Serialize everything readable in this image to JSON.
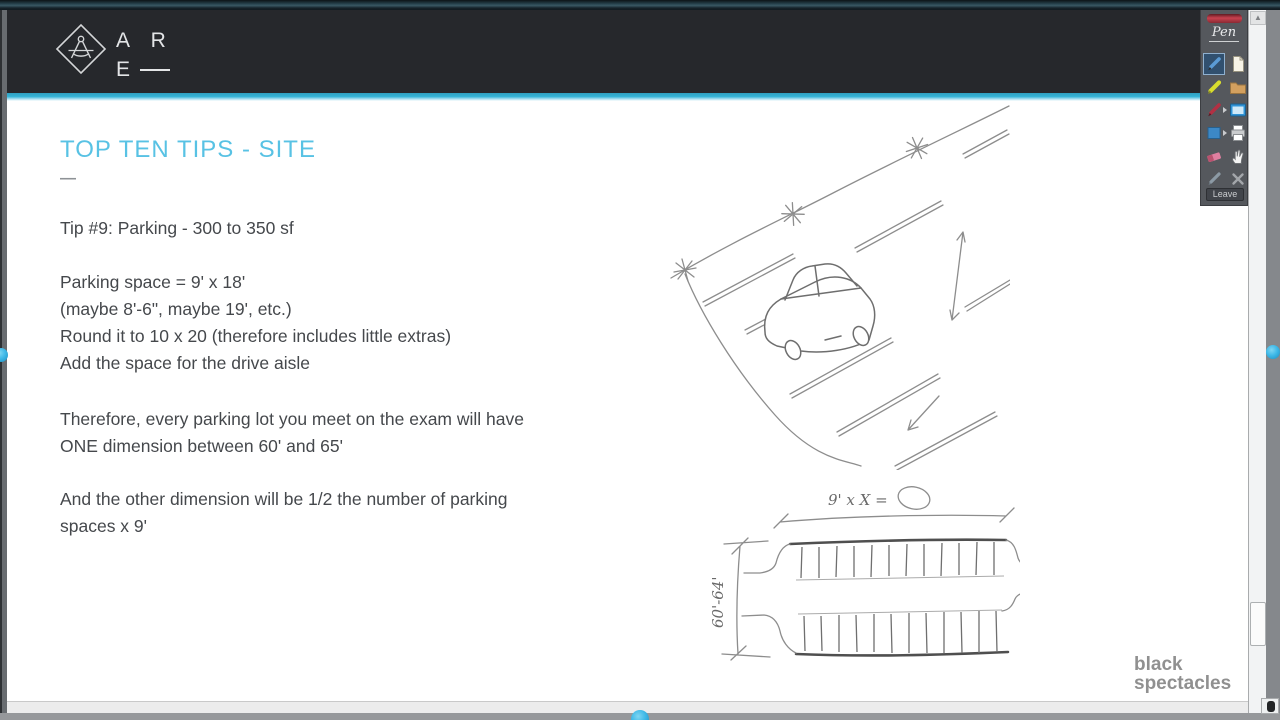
{
  "header": {
    "logo_text_line1": "A R",
    "logo_text_line2": "E"
  },
  "slide": {
    "title": "TOP TEN TIPS - SITE",
    "subtitle_dash": "—",
    "paragraphs": [
      {
        "lines": [
          "Tip #9: Parking - 300 to 350 sf"
        ]
      },
      {
        "lines": [
          "Parking space = 9' x 18'",
          "(maybe 8'-6\", maybe 19', etc.)",
          "Round it to 10 x 20 (therefore includes little extras)",
          "Add the space for the drive aisle"
        ]
      },
      {
        "lines": [
          "Therefore, every parking lot you meet on the exam will have",
          "ONE dimension between 60' and 65'"
        ]
      },
      {
        "lines": [
          "And the other dimension will be 1/2 the number of parking",
          "spaces x 9'"
        ]
      }
    ]
  },
  "sketches": {
    "parking_bay": {
      "top_dimension_label": "9' x X =",
      "side_dimension_label": "60'-64'"
    }
  },
  "toolbar": {
    "brand": "Pen",
    "leave_label": "Leave",
    "icons": [
      "pen-tool",
      "new-page",
      "highlighter-tool",
      "folder",
      "red-pen-tool",
      "window-select",
      "shapes-tool",
      "print",
      "eraser-tool",
      "pan-hand",
      "faded-pen-tool",
      "clear-x"
    ]
  },
  "scrollbar": {
    "up_glyph": "▲"
  },
  "watermark": {
    "line1": "black",
    "line2": "spectacles"
  },
  "colors": {
    "accent_cyan": "#35b3d6",
    "title_blue": "#58c2e4",
    "header_bg": "#26282c",
    "toolbar_bg": "#55585d",
    "body_text": "#45484c"
  }
}
